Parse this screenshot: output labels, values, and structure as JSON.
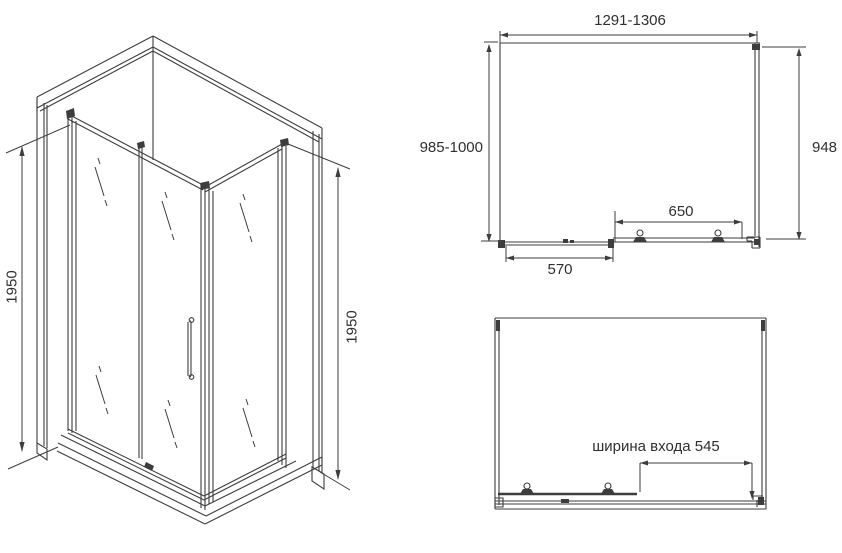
{
  "colors": {
    "line": "#3d3d3d",
    "text": "#2f2f2f",
    "background": "#ffffff"
  },
  "isometric_view": {
    "left_height_label": "1950",
    "right_height_label": "1950"
  },
  "top_plan_view": {
    "overall_width_label": "1291-1306",
    "depth_left_label": "985-1000",
    "depth_right_label": "948",
    "door_track_label": "650",
    "fixed_panel_label": "570"
  },
  "open_plan_view": {
    "entrance_width_label": "ширина входа 545"
  }
}
